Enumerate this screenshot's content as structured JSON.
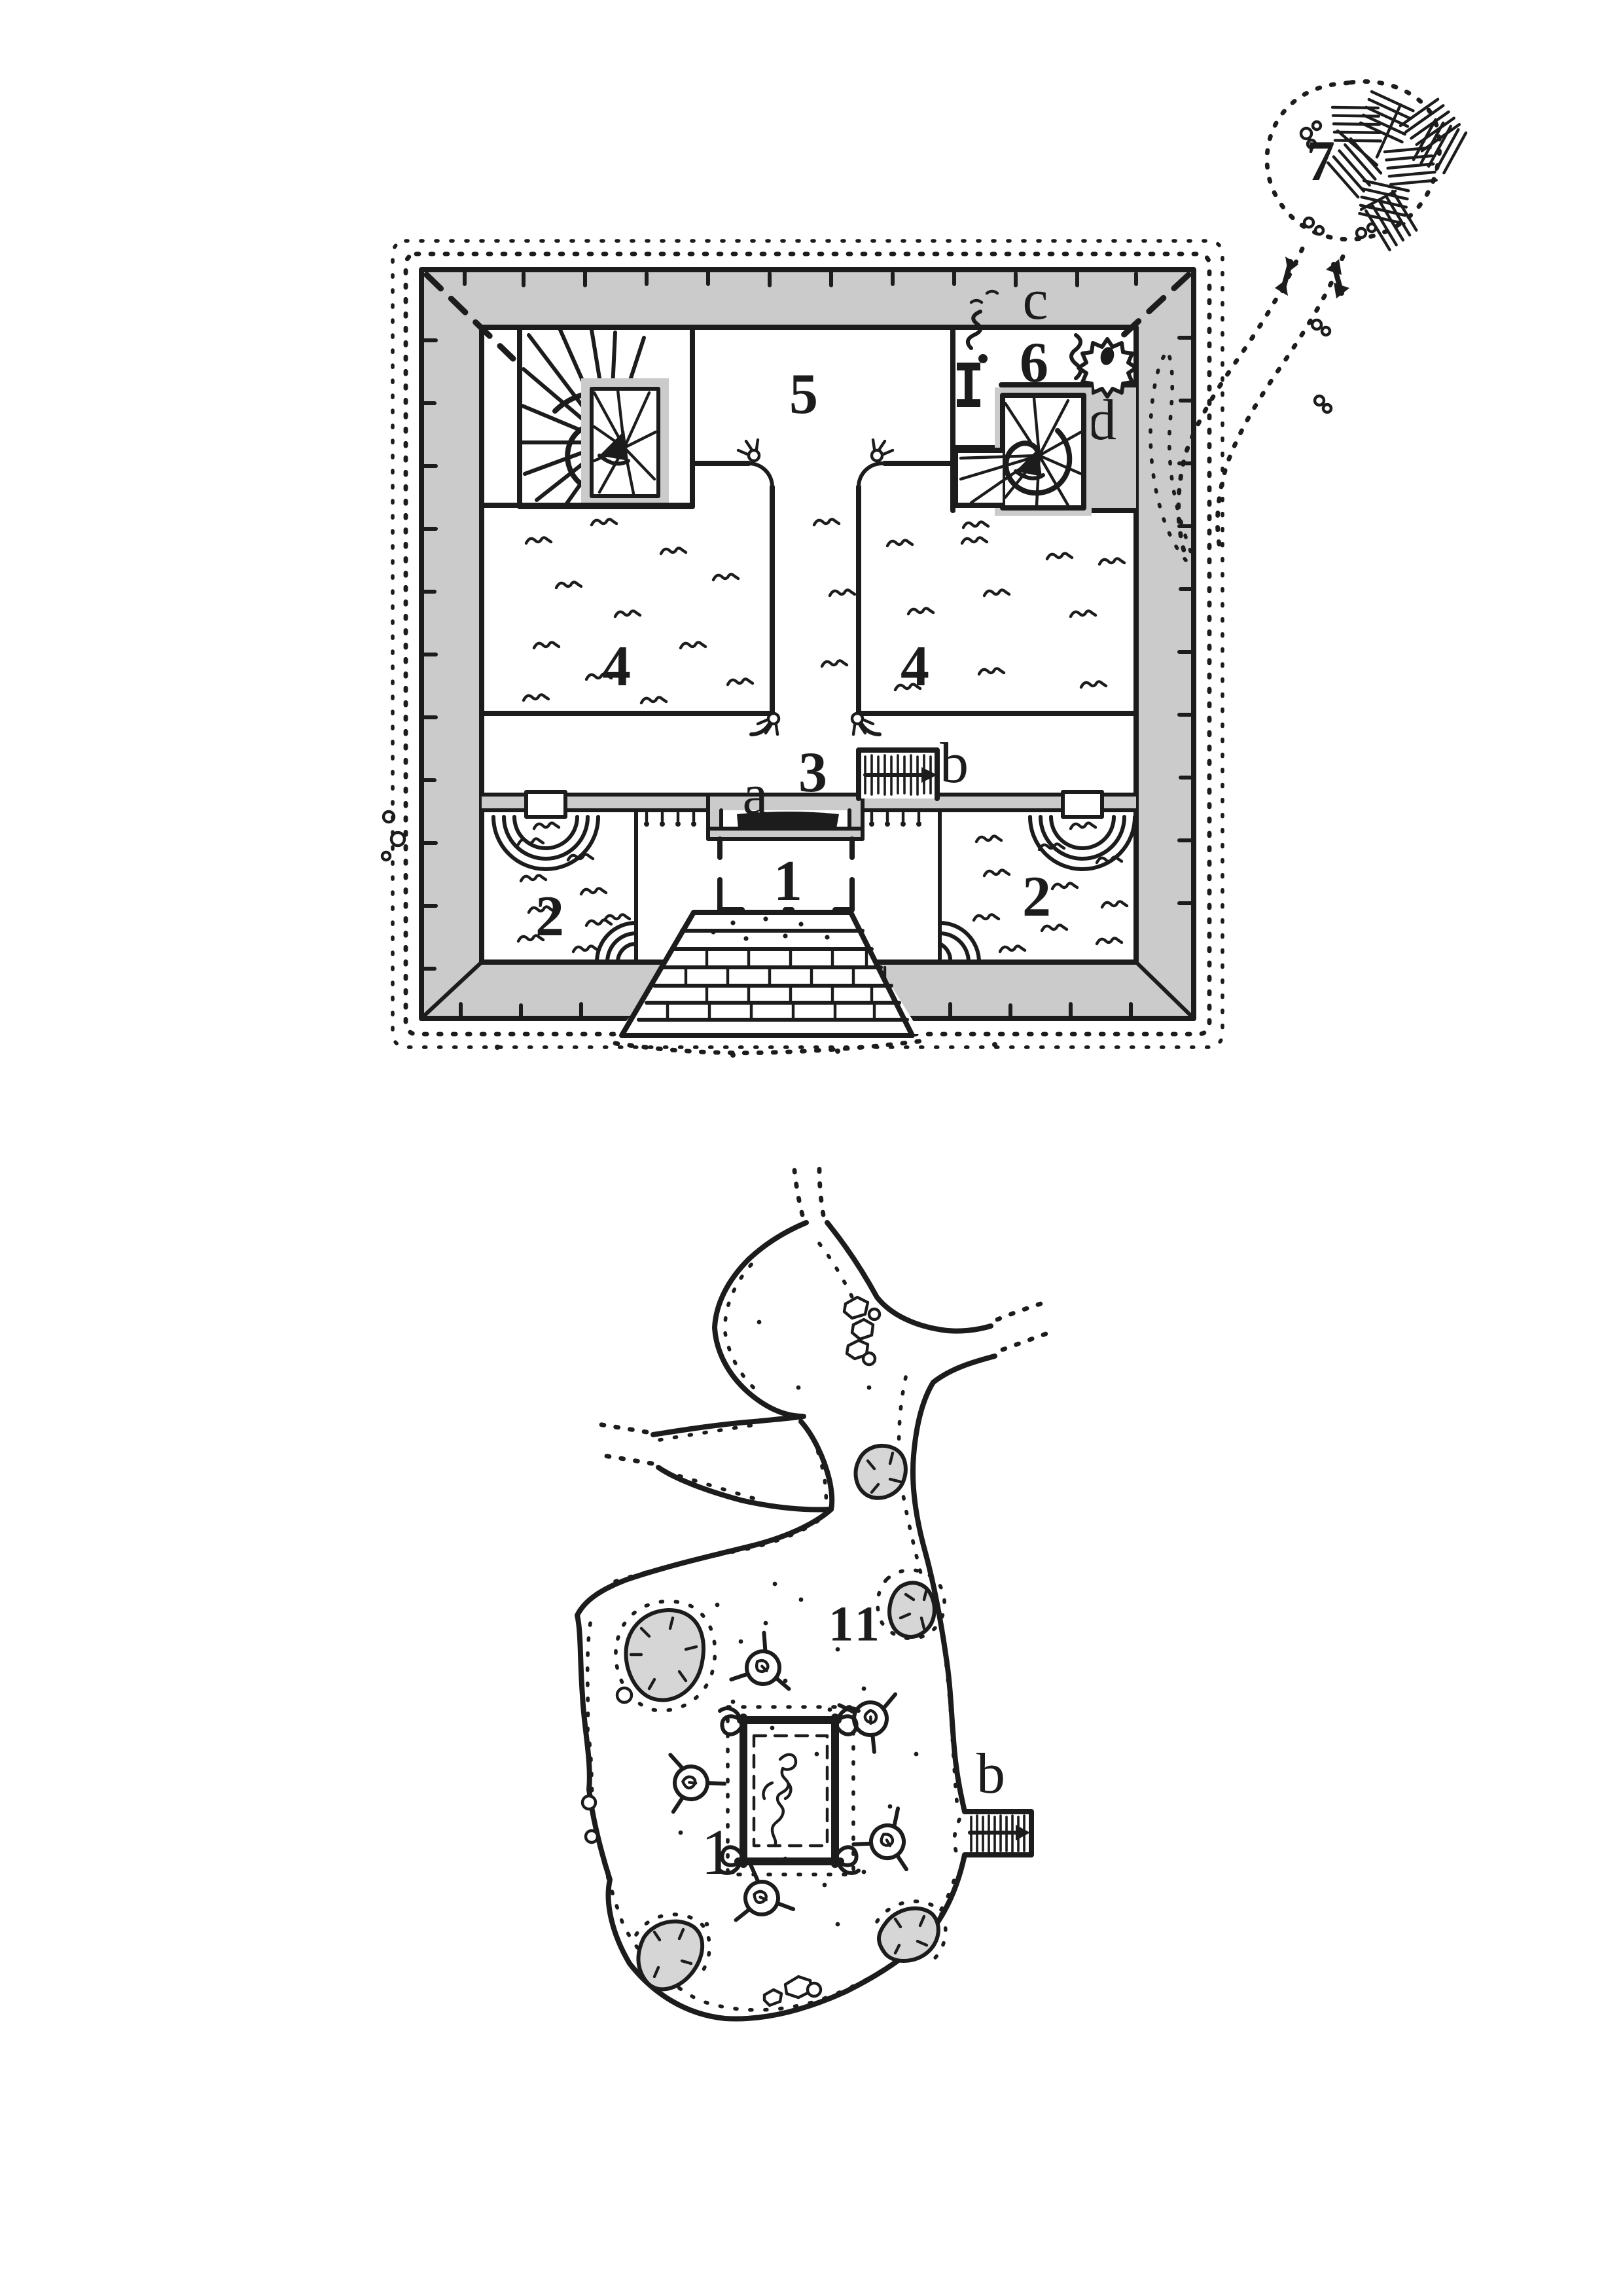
{
  "colors": {
    "ink": "#1c1c1c",
    "wall_fill": "#cbcbcb",
    "pit_fill": "#d6d6d6",
    "paper": "#ffffff"
  },
  "upper_map": {
    "name": "temple level",
    "rooms": {
      "r1": "1",
      "r2_left": "2",
      "r2_right": "2",
      "r3": "3",
      "r4_left": "4",
      "r4_right": "4",
      "r5": "5",
      "r6": "6",
      "r7": "7"
    },
    "features": {
      "a": "a",
      "b": "b",
      "c": "c",
      "d": "d"
    }
  },
  "lower_map": {
    "name": "cavern level",
    "rooms": {
      "r11": "11"
    },
    "features": {
      "rug": "1",
      "b": "b"
    }
  }
}
